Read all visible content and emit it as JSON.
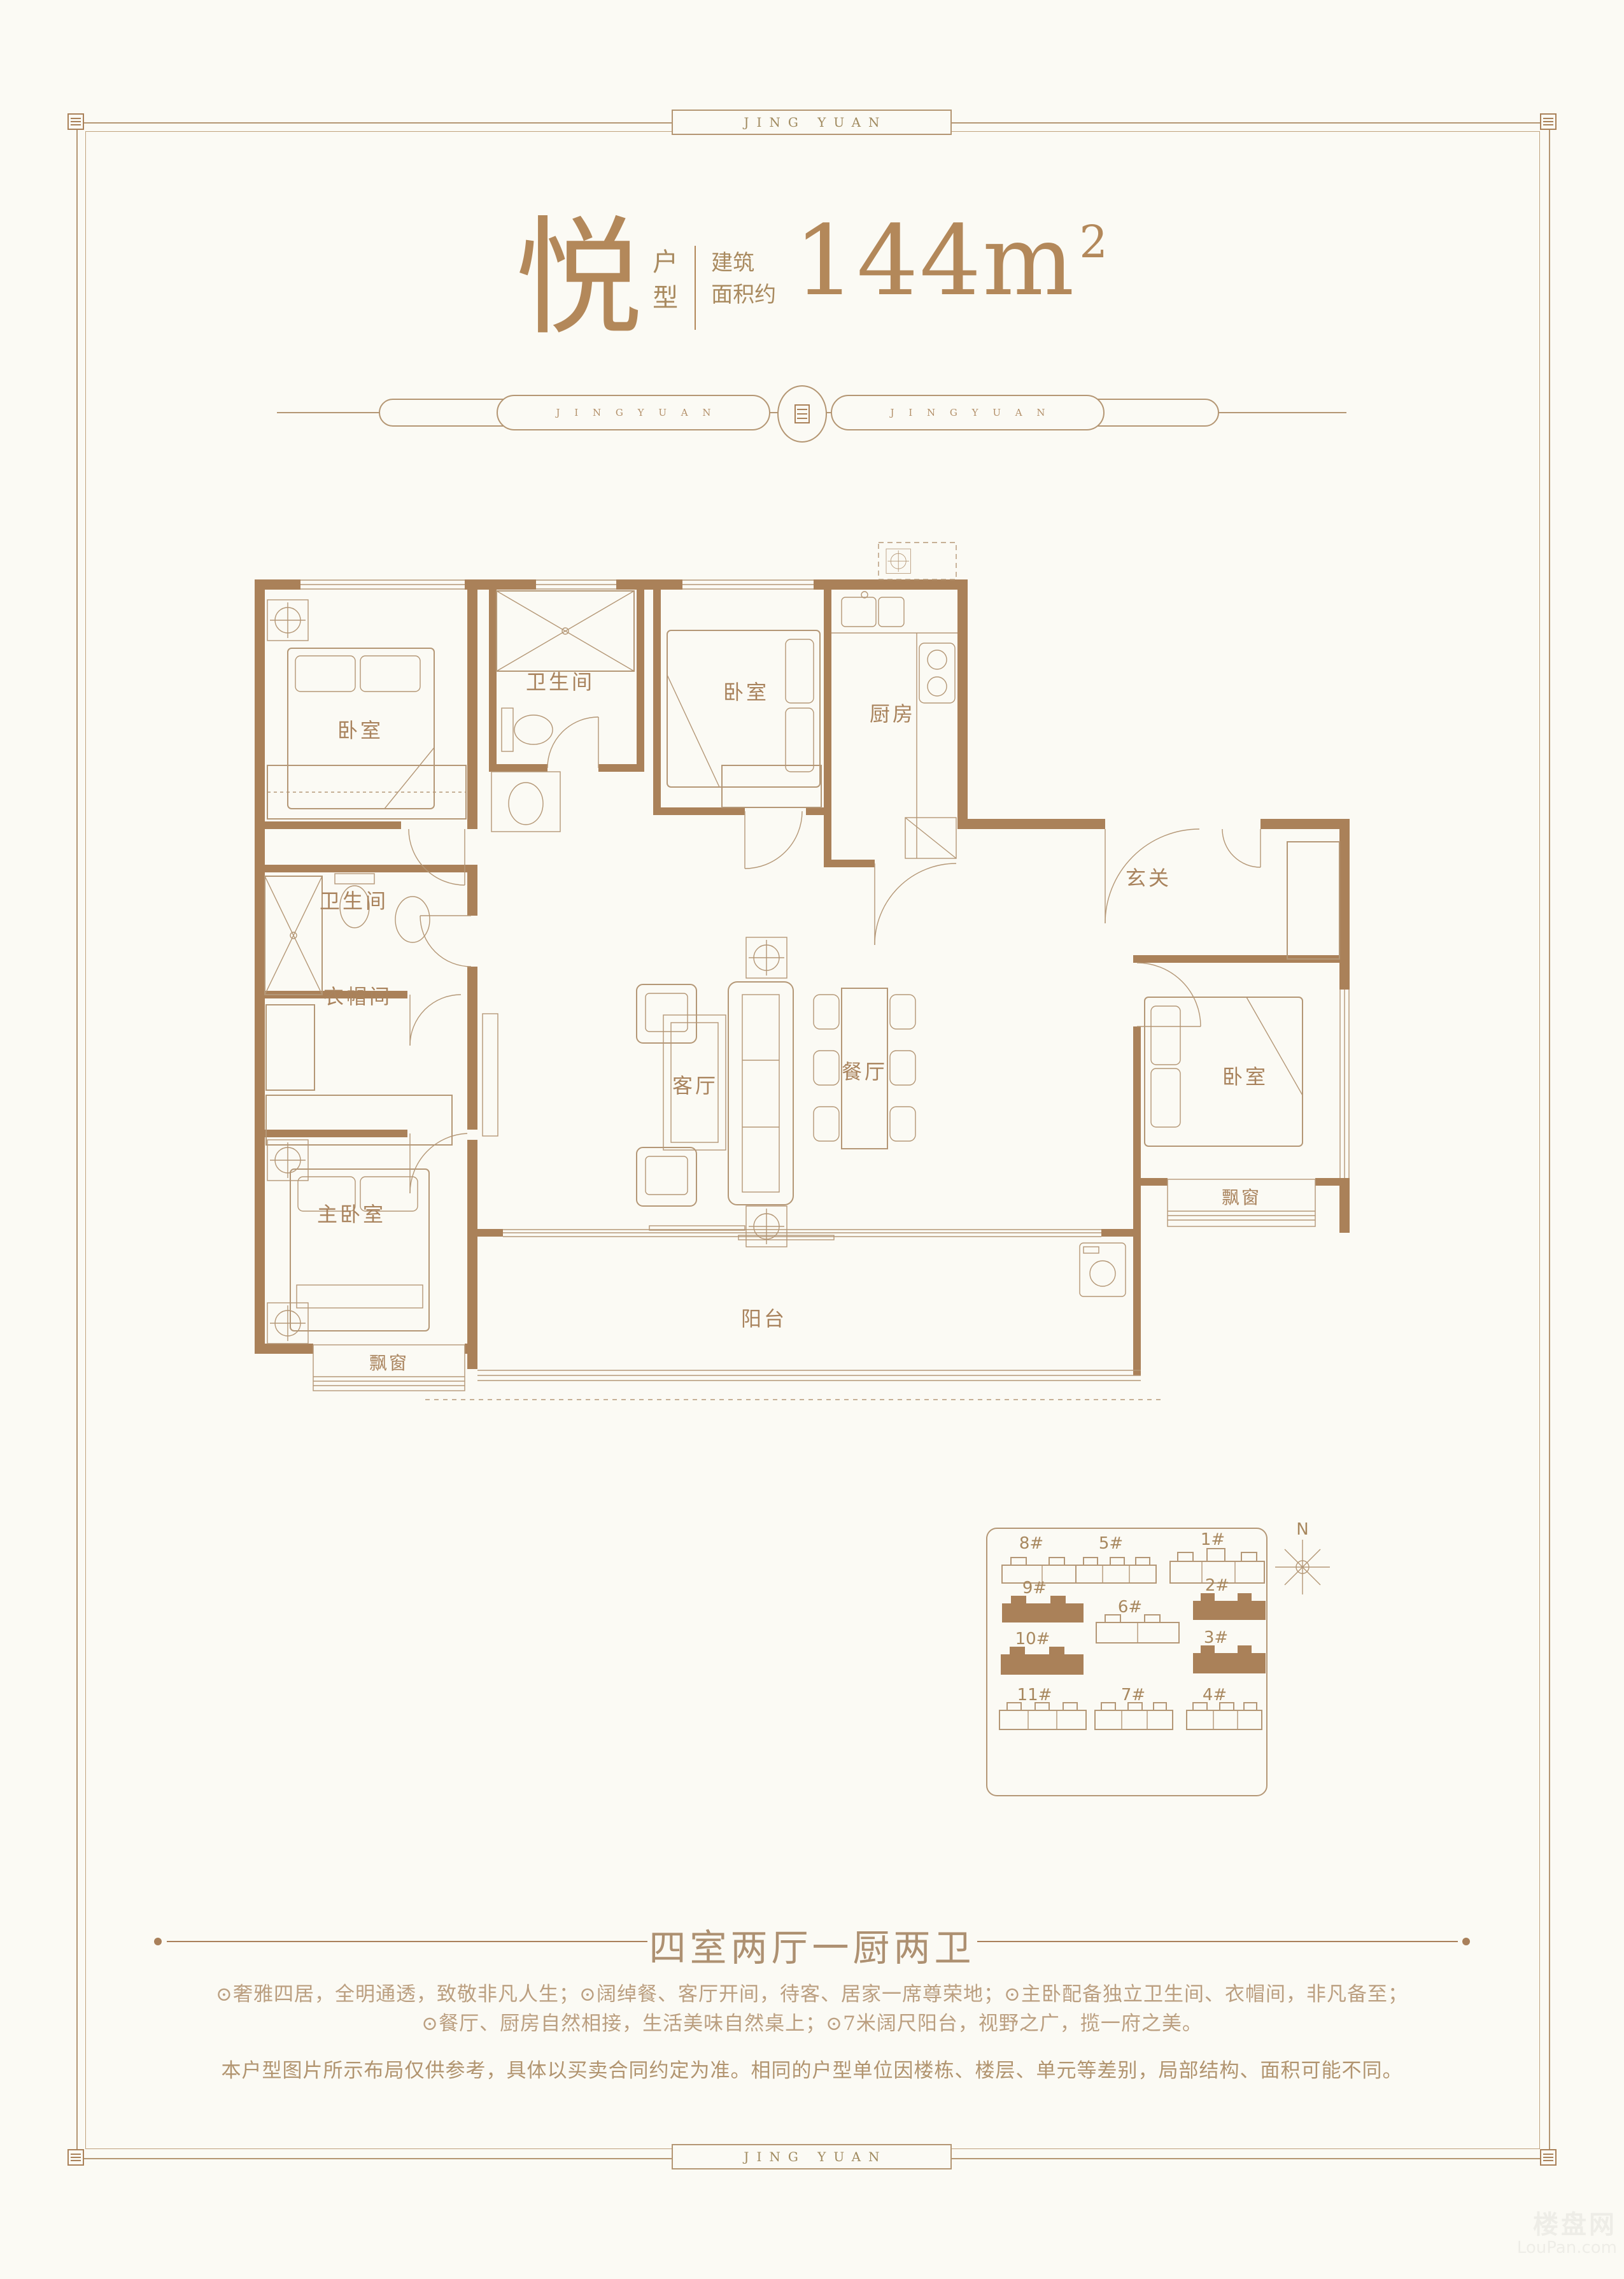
{
  "frame": {
    "top_label": "JING YUAN",
    "bottom_label": "JING YUAN"
  },
  "title": {
    "name": "悦",
    "type_top": "户",
    "type_bottom": "型",
    "area_label_1": "建筑",
    "area_label_2": "面积约",
    "area_value": "144m",
    "area_exponent": "2"
  },
  "divider": {
    "left_text": "J I N G Y U A N",
    "right_text": "J I N G Y U A N"
  },
  "floorplan": {
    "labels": {
      "bedroom_tl": "卧室",
      "bath_top": "卫生间",
      "bedroom_tm": "卧室",
      "kitchen": "厨房",
      "foyer": "玄关",
      "bath_mid": "卫生间",
      "cloakroom": "衣帽间",
      "master_bedroom": "主卧室",
      "living": "客厅",
      "dining": "餐厅",
      "bedroom_r": "卧室",
      "bay_r": "飘窗",
      "balcony": "阳台",
      "bay_bl": "飘窗"
    }
  },
  "siteplan": {
    "north": "N",
    "buildings": [
      {
        "label": "8#"
      },
      {
        "label": "5#"
      },
      {
        "label": "1#"
      },
      {
        "label": "9#"
      },
      {
        "label": "2#"
      },
      {
        "label": "6#"
      },
      {
        "label": "10#"
      },
      {
        "label": "3#"
      },
      {
        "label": "11#"
      },
      {
        "label": "7#"
      },
      {
        "label": "4#"
      }
    ]
  },
  "summary_title": "四室两厅一厨两卫",
  "features": [
    "⊙奢雅四居，全明通透，致敬非凡人生；⊙阔绰餐、客厅开间，待客、居家一席尊荣地；⊙主卧配备独立卫生间、衣帽间，非凡备至；",
    "⊙餐厅、厨房自然相接，生活美味自然桌上；⊙7米阔尺阳台，视野之广，揽一府之美。"
  ],
  "disclaimer": "本户型图片所示布局仅供参考，具体以买卖合同约定为准。相同的户型单位因楼栋、楼层、单元等差别，局部结构、面积可能不同。",
  "watermark": {
    "cn": "楼盘网",
    "en": "LouPan.com"
  },
  "colors": {
    "accent": "#b49673",
    "wall": "#aa8159",
    "label": "#a9835d"
  }
}
